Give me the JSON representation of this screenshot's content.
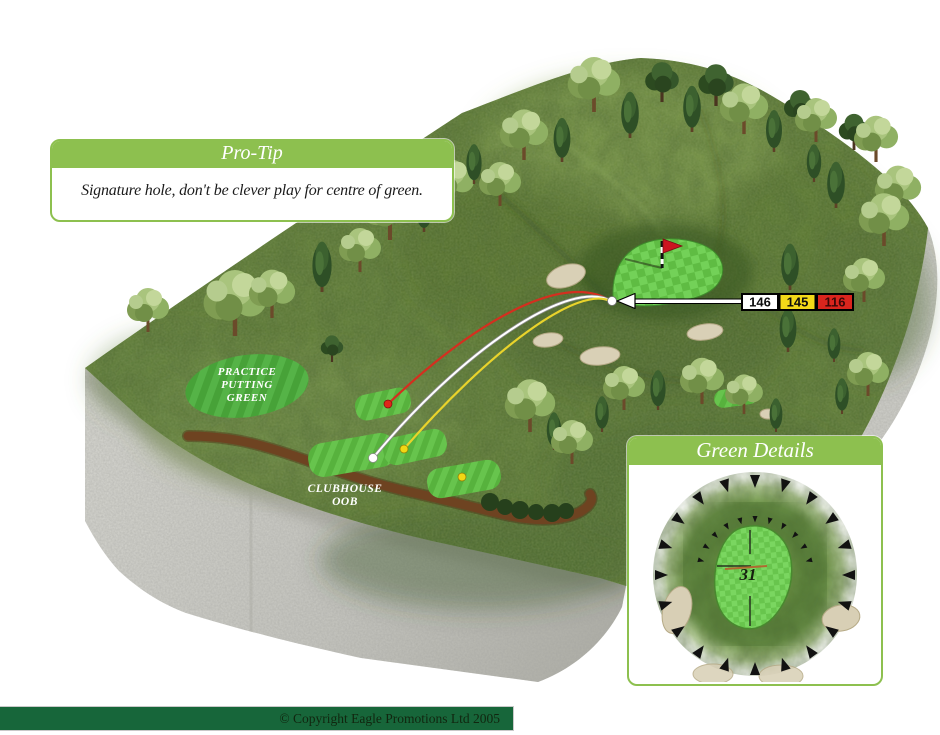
{
  "protip": {
    "title": "Pro-Tip",
    "text": "Signature hole, don't be clever play for centre of green."
  },
  "course_labels": {
    "practice_green": [
      "PRACTICE",
      "PUTTING",
      "GREEN"
    ],
    "clubhouse": [
      "CLUBHOUSE",
      "OOB"
    ]
  },
  "distance_markers": {
    "white": "146",
    "yellow": "145",
    "red": "116"
  },
  "green_details": {
    "title": "Green Details",
    "green_depth": "31"
  },
  "footer": {
    "copyright": "© Copyright Eagle Promotions Ltd 2005"
  },
  "colors": {
    "panel_green": "#8dc04f",
    "footer_green": "#17663a",
    "marker_white": "#ffffff",
    "marker_yellow": "#f3d918",
    "marker_red": "#da251d",
    "flag_red": "#cc1520"
  }
}
